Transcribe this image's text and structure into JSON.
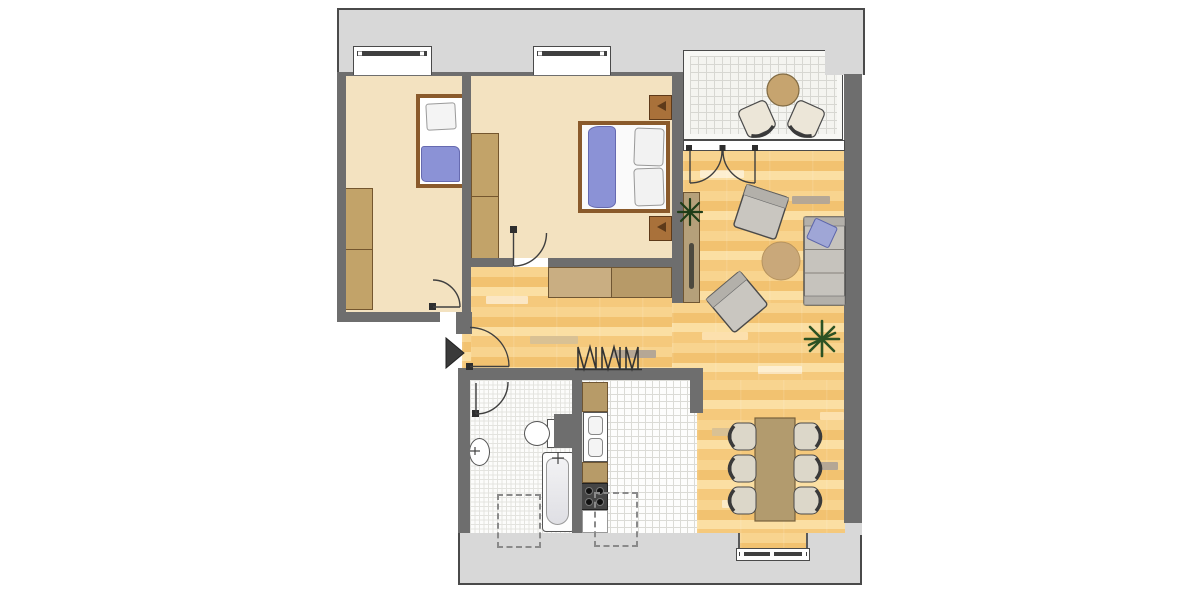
{
  "meta": {
    "kind": "apartment-floor-plan",
    "visible_text": "none"
  },
  "palette": {
    "facade_gray": "#d8d8d8",
    "outline_dark": "#4a4a4a",
    "wall_gray": "#6e6e6e",
    "bedroom_floor_beige": "#f3e2c0",
    "parquet_base": "#f5c97c",
    "parquet_light": "#fbdfa3",
    "parquet_dark": "#f2c270",
    "tile_white": "#fdfdfc",
    "cabinet_wood": "#c2a369",
    "bed_frame_brown": "#8a5a2b",
    "textile_blue": "#8b92d6",
    "upholstery_gray": "#c6c3bd",
    "rug_tan": "#c9a87a",
    "table_tan": "#b29b6e",
    "plant_green": "#1e3d18",
    "fixture_white": "#ffffff"
  },
  "rooms": [
    {
      "name": "bedroom-1",
      "floor": "beige",
      "furniture": [
        "single-bed",
        "wardrobe"
      ]
    },
    {
      "name": "bedroom-2",
      "floor": "beige",
      "furniture": [
        "double-bed",
        "two-nightstands",
        "wardrobe"
      ]
    },
    {
      "name": "hallway",
      "floor": "parquet",
      "furniture": [
        "sideboard",
        "coat-rack"
      ]
    },
    {
      "name": "living-dining-room",
      "floor": "parquet",
      "furniture": [
        "sofa",
        "two-armchairs",
        "round-rug",
        "tall-cabinet",
        "dining-table",
        "six-chairs",
        "two-plants"
      ]
    },
    {
      "name": "kitchen",
      "floor": "white-tile",
      "furniture": [
        "counter",
        "sink",
        "stove"
      ]
    },
    {
      "name": "bathroom",
      "floor": "white-tile-fine",
      "furniture": [
        "bathtub",
        "toilet",
        "washbasin"
      ]
    },
    {
      "name": "balcony",
      "floor": "gray-tile",
      "furniture": [
        "round-table",
        "two-chairs"
      ]
    }
  ],
  "symbols": [
    "entrance-arrow",
    "door-swing-arcs",
    "window-bars",
    "dashed-underfloor-outlines",
    "coat-rack-zigzag"
  ]
}
